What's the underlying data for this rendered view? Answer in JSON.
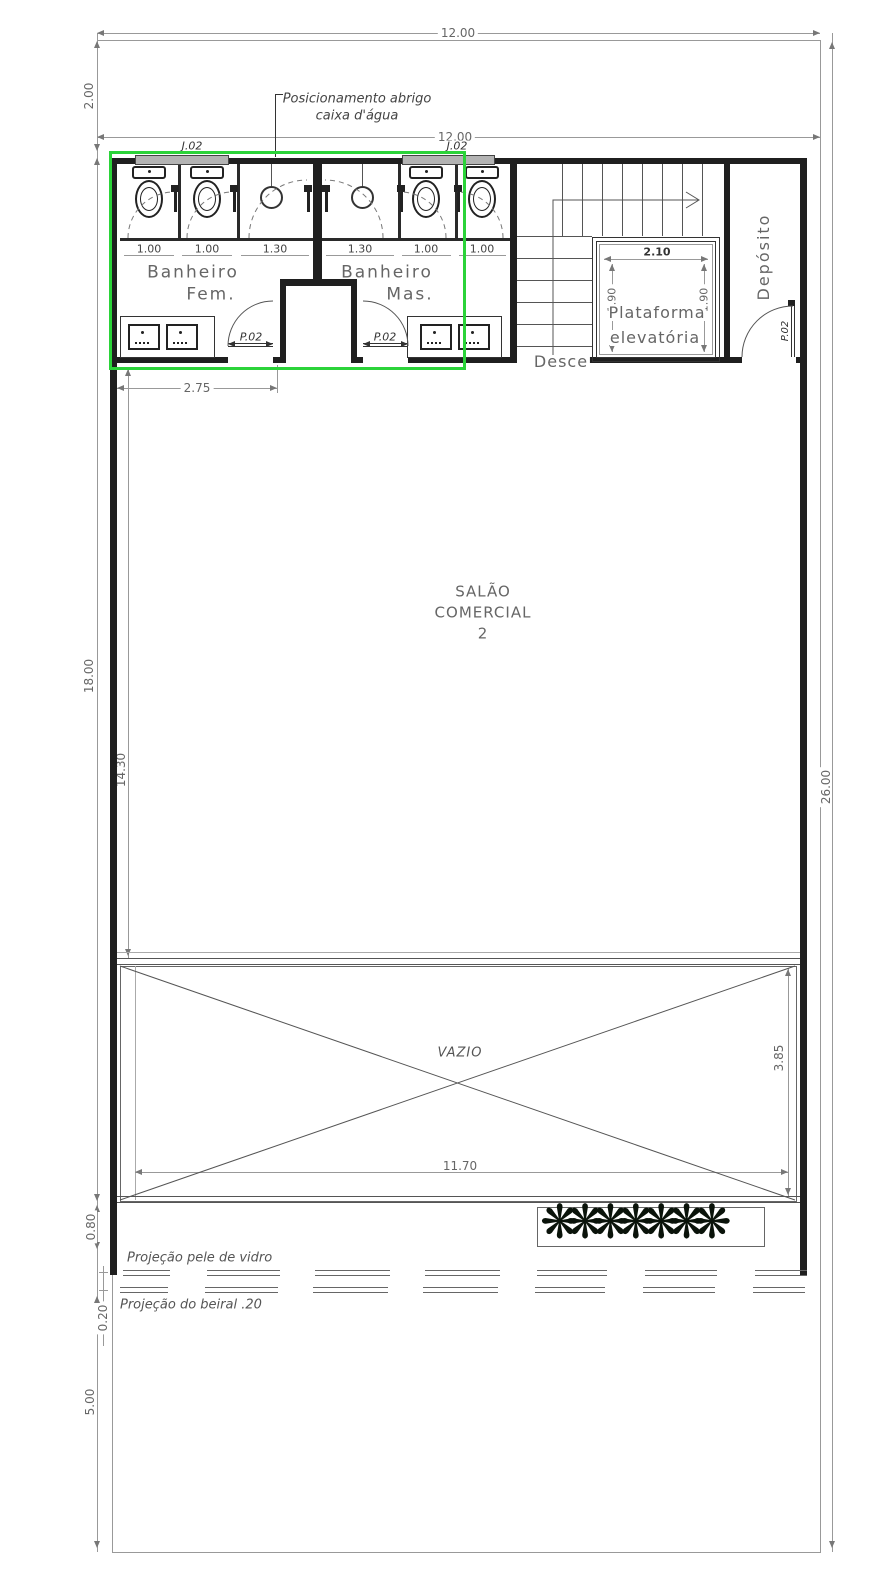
{
  "plan": {
    "annotations": {
      "posicionamento_1": "Posicionamento abrigo",
      "posicionamento_2": "caixa d'água",
      "projecao_vidro": "Projeção pele de vidro",
      "projecao_beiral": "Projeção do beiral .20"
    },
    "rooms": {
      "banheiro_fem_1": "Banheiro",
      "banheiro_fem_2": "Fem.",
      "banheiro_mas_1": "Banheiro",
      "banheiro_mas_2": "Mas.",
      "salao_1": "SALÃO",
      "salao_2": "COMERCIAL",
      "salao_3": "2",
      "plataforma_1": "Plataforma",
      "plataforma_2": "elevatória",
      "deposito": "Depósito",
      "desce": "Desce",
      "vazio": "VAZIO"
    },
    "tags": {
      "janela": "J.02",
      "porta": "P.02"
    },
    "dims": {
      "d1200": "12.00",
      "d200": "2.00",
      "d275": "2.75",
      "d1800": "18.00",
      "d1430": "14.30",
      "d2600": "26.00",
      "d100": "1.00",
      "d130": "1.30",
      "d210": "2.10",
      "d190": "1.90",
      "d1170": "11.70",
      "d385": "3.85",
      "d080": "0.80",
      "d020": "0.20",
      "d500": "5.00"
    },
    "decor": {
      "plants": "❋❋❋❋❋❋❋"
    },
    "colors": {
      "highlight": "#2bd339"
    }
  }
}
